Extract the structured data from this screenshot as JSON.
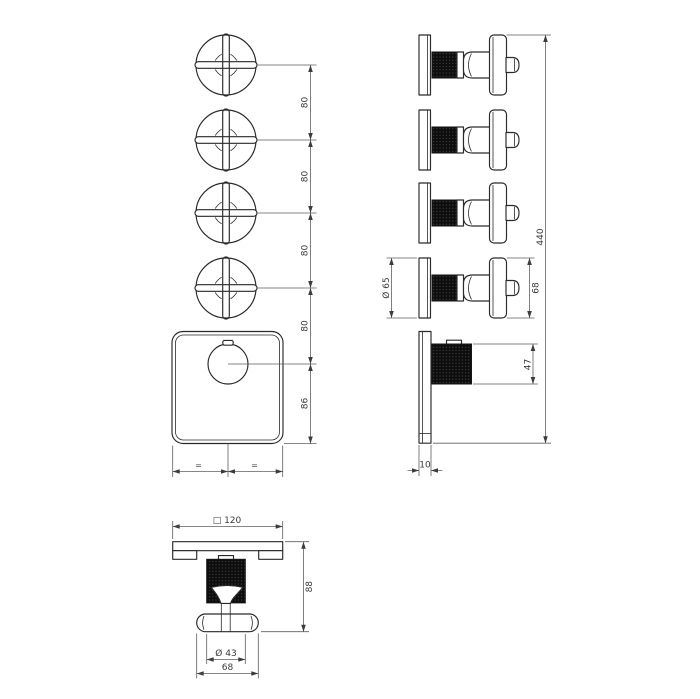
{
  "drawing": {
    "colors": {
      "ink": "#2a2a2a",
      "dimension": "#5f5f5f",
      "knurl_fill": "#0d0d0d"
    },
    "front_view": {
      "handle_spacing": [
        "80",
        "80",
        "80",
        "80"
      ],
      "knob_offset": "86",
      "equal_marks": [
        "=",
        "="
      ]
    },
    "side_view": {
      "overall_height": "440",
      "plate_diameter": "Ø 65",
      "handle_height": "68",
      "knob_height": "47",
      "plate_thickness": "10"
    },
    "bottom_view": {
      "plate_square": "□ 120",
      "overall_depth": "88",
      "knob_diameter": "Ø 43",
      "handle_width": "68"
    }
  }
}
